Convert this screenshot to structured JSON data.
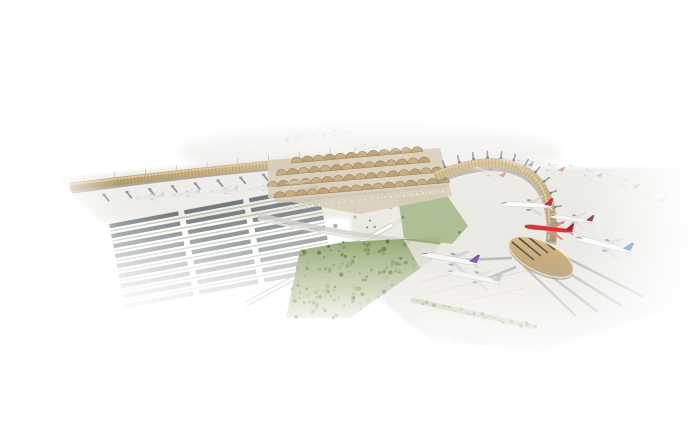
{
  "image": {
    "type": "architectural-render",
    "subject": "aerial rendering of an airport: main terminal with umbrella canopy roof, long straight pier, curved crescent concourse with oval pier-end building, parked airliners, solar carport parking, people mover track, forest landscaping",
    "background": "#ffffff"
  },
  "palette": {
    "white": "#ffffff",
    "apron": "#ebe9e4",
    "apron2": "#e4e2db",
    "tan": "#c8ad82",
    "tanLight": "#e2d1aa",
    "tanDark": "#a98e61",
    "rib": "#8a6f4b",
    "gold": "#c4a36c",
    "goldHi": "#eedeb6",
    "goldDark": "#8f7447",
    "stripe": "#3f382f",
    "structure": "#7d8286",
    "structureLight": "#b9bdbf",
    "grass": "#a9ba8c",
    "grassDark": "#8ba06c",
    "tree": "#5d7144",
    "tree2": "#7c9157",
    "tree3": "#99ab77",
    "road": "#d8d6cf",
    "roadLight": "#e9e7e1",
    "panel": "#5e6567",
    "panelEdge": "#d7dbda",
    "hedge": "#93a478",
    "taxiLine": "#d8c27c",
    "trackGray": "#c6c6c0",
    "canopyA": "#c9ad80",
    "canopyB": "#bfa172",
    "canopyStroke": "#8f7750",
    "terrace": "#d9cfba",
    "busShelter": "#d8d8d4"
  },
  "scene": {
    "curve": {
      "path": [
        436,
        176,
        495,
        149,
        560,
        159,
        551,
        242
      ],
      "width": 9
    },
    "leftPier": {
      "x0": 70,
      "y0": 187,
      "x1": 338,
      "y1": 159,
      "width": 8.5
    },
    "oval": {
      "cx": 541,
      "cy": 257,
      "rx": 35,
      "ry": 15,
      "rot": 26
    },
    "gates": {
      "count": 12,
      "t0": 0.06,
      "t1": 0.92
    },
    "bridges": {
      "count": 11
    },
    "masts": {
      "count": 9
    },
    "canopies": {
      "rotate": -5,
      "cx": 350,
      "cy": 175,
      "spacing": 11,
      "r": 5.6,
      "rows": [
        {
          "y": 158,
          "x0": 298,
          "x1": 420
        },
        {
          "y": 169,
          "x0": 282,
          "x1": 432
        },
        {
          "y": 180,
          "x0": 272,
          "x1": 440
        },
        {
          "y": 191,
          "x0": 278,
          "x1": 444
        }
      ]
    },
    "parking": {
      "rotate": -10.5,
      "cx": 210,
      "cy": 252,
      "rowCount": 9,
      "y0": 206,
      "rowStep": 10.2,
      "panelH": 4.4,
      "segments": [
        [
          116,
          70
        ],
        [
          192,
          60
        ],
        [
          258,
          70
        ]
      ]
    },
    "forest": {
      "polygon": [
        [
          286,
          318
        ],
        [
          300,
          250
        ],
        [
          344,
          242
        ],
        [
          442,
          237
        ],
        [
          432,
          260
        ],
        [
          350,
          318
        ]
      ],
      "treeCount": 150
    },
    "terminalTrees": {
      "polygon": [
        [
          306,
          198
        ],
        [
          448,
          186
        ],
        [
          472,
          230
        ],
        [
          424,
          248
        ],
        [
          334,
          226
        ]
      ],
      "treeCount": 16
    },
    "treeStrip": {
      "x0": 412,
      "y0": 300,
      "x1": 534,
      "y1": 327,
      "treeCount": 26
    },
    "corridors": [
      [
        524,
        266,
        576,
        316
      ],
      [
        538,
        266,
        598,
        312
      ],
      [
        551,
        262,
        622,
        306
      ],
      [
        561,
        255,
        644,
        297
      ],
      [
        512,
        258,
        466,
        260
      ],
      [
        516,
        267,
        486,
        279
      ]
    ],
    "planes": [
      {
        "name": "thai-purple-tail",
        "x": 450,
        "y": 259,
        "rot": 10,
        "s": 1.0,
        "body": "#f6f4f8",
        "tail": "#6f3e9e",
        "wing": "#cfcad6",
        "opacity": 1
      },
      {
        "name": "white-regional",
        "x": 474,
        "y": 277,
        "rot": 12,
        "s": 0.95,
        "body": "#f2f2f1",
        "tail": "#b9b9b6",
        "wing": "#d9d9d6",
        "opacity": 1
      },
      {
        "name": "red-tail-widebody",
        "x": 527,
        "y": 205,
        "rot": 3,
        "s": 0.9,
        "body": "#fbfbfb",
        "tail": "#cd3038",
        "wing": "#d9d9d6",
        "opacity": 1
      },
      {
        "name": "red-lowcost",
        "x": 549,
        "y": 229,
        "rot": 6,
        "s": 0.85,
        "body": "#d8362e",
        "tail": "#b01f2e",
        "wing": "#e08a84",
        "opacity": 1
      },
      {
        "name": "maroon-tail",
        "x": 572,
        "y": 219,
        "rot": 8,
        "s": 0.75,
        "body": "#f7f5f4",
        "tail": "#8c2138",
        "wing": "#dcdcd9",
        "opacity": 1
      },
      {
        "name": "blue-tail-widebody",
        "x": 604,
        "y": 245,
        "rot": 14,
        "s": 1.0,
        "body": "#fafbfc",
        "tail": "#3a6cb0",
        "wing": "#d4d9de",
        "opacity": 1
      },
      {
        "name": "gate-plane-1",
        "x": 150,
        "y": 197,
        "rot": -6,
        "s": 0.5,
        "body": "#e3e3e0",
        "tail": "#b9b9b6",
        "wing": "#d6d6d3",
        "opacity": 0.5
      },
      {
        "name": "gate-plane-2",
        "x": 186,
        "y": 194,
        "rot": -6,
        "s": 0.5,
        "body": "#e3e3e0",
        "tail": "#b9b9b6",
        "wing": "#d6d6d3",
        "opacity": 0.5
      },
      {
        "name": "gate-plane-3",
        "x": 224,
        "y": 191,
        "rot": -6,
        "s": 0.5,
        "body": "#e3e3e0",
        "tail": "#b9b9b6",
        "wing": "#d6d6d3",
        "opacity": 0.5
      },
      {
        "name": "gate-plane-4",
        "x": 262,
        "y": 188,
        "rot": -6,
        "s": 0.5,
        "body": "#e3e3e0",
        "tail": "#b9b9b6",
        "wing": "#d6d6d3",
        "opacity": 0.45
      },
      {
        "name": "gate-plane-5",
        "x": 298,
        "y": 182,
        "rot": -6,
        "s": 0.45,
        "body": "#e3e3e0",
        "tail": "#b9b9b6",
        "wing": "#d6d6d3",
        "opacity": 0.4
      },
      {
        "name": "remote-plane-1",
        "x": 300,
        "y": 136,
        "rot": 175,
        "s": 0.5,
        "body": "#e6e6e3",
        "tail": "#b5b5b2",
        "wing": "#d6d6d3",
        "opacity": 0.3
      },
      {
        "name": "remote-plane-2",
        "x": 336,
        "y": 133,
        "rot": 175,
        "s": 0.5,
        "body": "#e6e6e3",
        "tail": "#b5b5b2",
        "wing": "#d6d6d3",
        "opacity": 0.3
      },
      {
        "name": "remote-plane-3",
        "x": 366,
        "y": 147,
        "rot": 175,
        "s": 0.45,
        "body": "#e6e6e3",
        "tail": "#b5b5b2",
        "wing": "#d6d6d3",
        "opacity": 0.28
      },
      {
        "name": "remote-plane-4",
        "x": 395,
        "y": 150,
        "rot": 178,
        "s": 0.4,
        "body": "#e6e6e3",
        "tail": "#b5b5b2",
        "wing": "#d6d6d3",
        "opacity": 0.25
      },
      {
        "name": "curve-gate-plane-1",
        "x": 488,
        "y": 172,
        "rot": 20,
        "s": 0.6,
        "body": "#f2f1ef",
        "tail": "#bf4a4a",
        "wing": "#dcdcd9",
        "opacity": 0.45
      },
      {
        "name": "curve-gate-plane-2",
        "x": 516,
        "y": 163,
        "rot": 15,
        "s": 0.6,
        "body": "#f2f1ef",
        "tail": "#4a66b0",
        "wing": "#dcdcd9",
        "opacity": 0.45
      },
      {
        "name": "curve-gate-plane-3",
        "x": 547,
        "y": 167,
        "rot": 18,
        "s": 0.6,
        "body": "#f2f1ef",
        "tail": "#bf4a4a",
        "wing": "#dcdcd9",
        "opacity": 0.42
      },
      {
        "name": "curve-gate-plane-4",
        "x": 585,
        "y": 172,
        "rot": 22,
        "s": 0.6,
        "body": "#f2f1ef",
        "tail": "#7f8fb8",
        "wing": "#dcdcd9",
        "opacity": 0.4
      },
      {
        "name": "curve-gate-plane-5",
        "x": 622,
        "y": 182,
        "rot": 25,
        "s": 0.6,
        "body": "#f2f1ef",
        "tail": "#c05555",
        "wing": "#dcdcd9",
        "opacity": 0.35
      },
      {
        "name": "curve-gate-plane-6",
        "x": 648,
        "y": 195,
        "rot": 28,
        "s": 0.6,
        "body": "#f2f1ef",
        "tail": "#4a66b0",
        "wing": "#dcdcd9",
        "opacity": 0.3
      }
    ]
  }
}
